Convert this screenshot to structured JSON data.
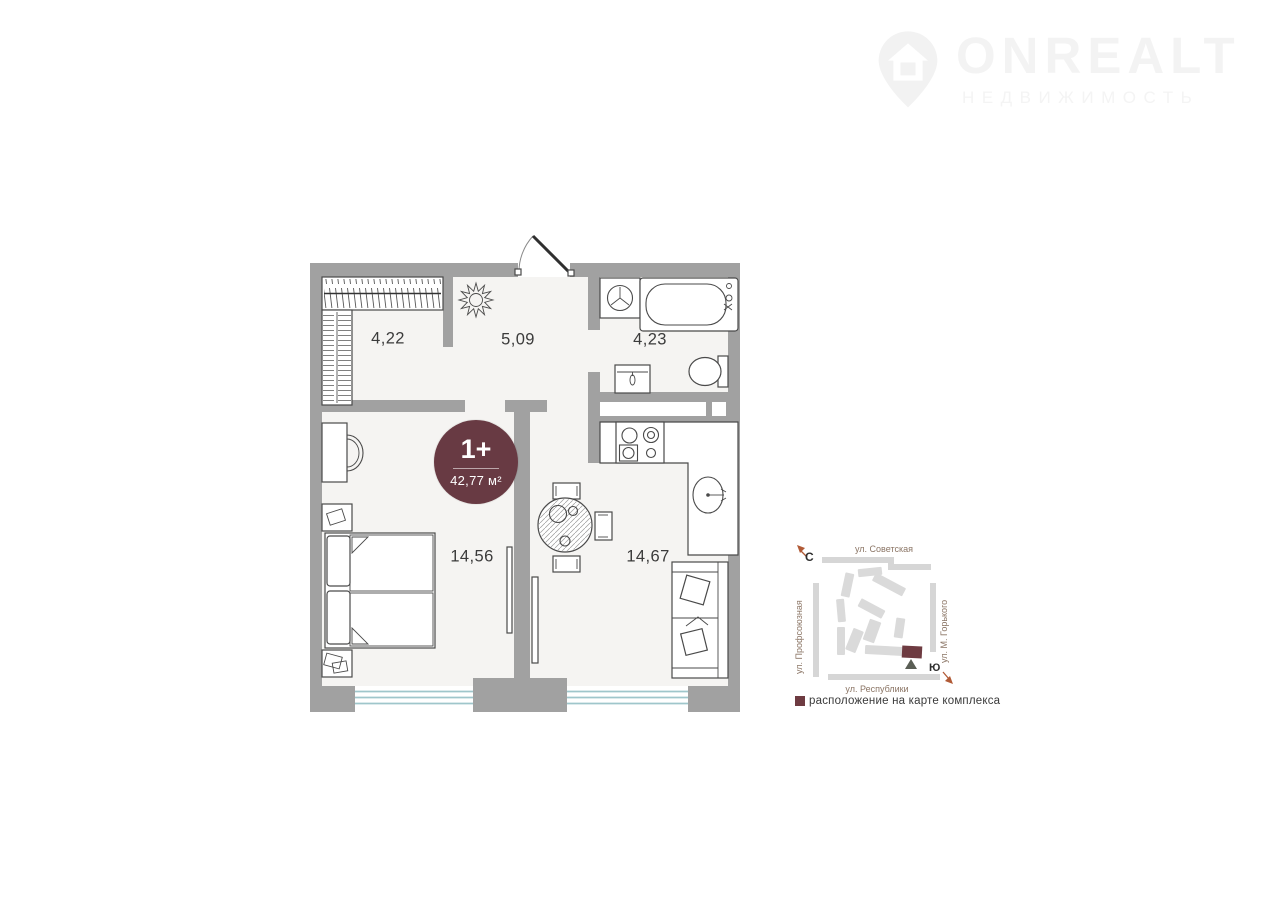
{
  "watermark": {
    "brand": "ONREALT",
    "subtitle": "НЕДВИЖИМОСТЬ"
  },
  "unit_badge": {
    "rooms": "1+",
    "area": "42,77 м²"
  },
  "floorplan": {
    "room_labels": [
      {
        "name": "wardrobe",
        "area": "4,22"
      },
      {
        "name": "hall",
        "area": "5,09"
      },
      {
        "name": "bathroom",
        "area": "4,23"
      },
      {
        "name": "bedroom",
        "area": "14,56"
      },
      {
        "name": "living-kitchen",
        "area": "14,67"
      }
    ]
  },
  "site_map": {
    "streets": {
      "top": "ул. Советская",
      "left": "ул. Профсоюзная",
      "right": "ул. М. Горького",
      "bottom": "ул. Республики"
    },
    "compass": {
      "north": "С",
      "south": "Ю"
    },
    "legend": "расположение на карте комплекса"
  },
  "colors": {
    "accent": "#6e3b41",
    "badge": "#683a43",
    "wall": "#a1a1a1",
    "window": "#9fc6cb",
    "map_street": "#d6d6d6",
    "map_building": "#dadada"
  }
}
